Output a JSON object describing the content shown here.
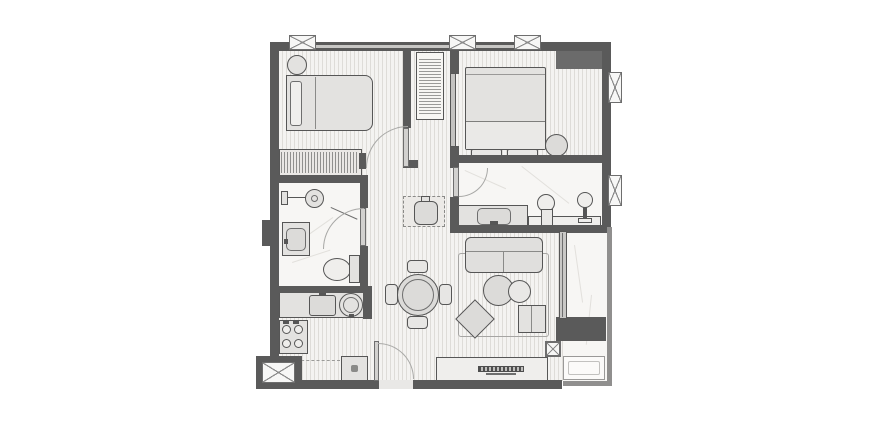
{
  "drawing": {
    "kind": "architectural-floor-plan",
    "description": "monochrome top-down apartment floor plan, no text labels",
    "palette": {
      "background": "#ffffff",
      "wall": "#5a5a5a",
      "parapet": "#908f8e",
      "outline": "#565656",
      "wood_floor_base": "#f4f3f1",
      "wood_floor_stripe": "#dedcd8",
      "marble_floor": "#f7f6f4",
      "furniture_fill": "#e3e2e0",
      "glass": "#c9c8c6",
      "door_arc": "#a8a8a6"
    },
    "rooms": [
      {
        "name": "bedroom-1",
        "floor": "wood",
        "furniture": [
          "single-bed",
          "pillow",
          "round-stool",
          "hatched-dresser"
        ]
      },
      {
        "name": "hallway",
        "floor": "wood",
        "furniture": [
          "hatched-closet"
        ]
      },
      {
        "name": "bedroom-2",
        "floor": "wood",
        "furniture": [
          "double-bed",
          "two-foot-benches",
          "round-planter",
          "built-in-wardrobe"
        ]
      },
      {
        "name": "bathroom-1",
        "floor": "marble",
        "furniture": [
          "shower-head",
          "glass-screen",
          "vanity-sink",
          "toilet"
        ]
      },
      {
        "name": "ensuite-bathroom",
        "floor": "marble",
        "furniture": [
          "vanity-sink",
          "toilet",
          "pedestal-basin",
          "shelf-counter"
        ]
      },
      {
        "name": "kitchen",
        "floor": "wood",
        "furniture": [
          "counter",
          "kitchen-sink",
          "round-basin",
          "four-burner-stove",
          "appliance-cabinet",
          "dashed-cabinet-line"
        ]
      },
      {
        "name": "living-dining",
        "floor": "wood",
        "furniture": [
          "round-dining-table",
          "four-chairs",
          "two-seat-sofa",
          "rug",
          "round-coffee-tables",
          "rotated-ottoman",
          "side-table",
          "tv-console",
          "laundry-cabinet"
        ]
      },
      {
        "name": "balcony",
        "floor": "marble",
        "furniture": [
          "planter-bench"
        ]
      },
      {
        "name": "service-shaft",
        "floor": "none",
        "furniture": [
          "x-cross-symbol"
        ]
      }
    ],
    "symbols": {
      "top_wall_vent_boxes": 3,
      "right_wall_window_boxes": 2,
      "swing_door_arcs": 4,
      "sliding_panel_doors": 1,
      "glass_wall_sections": 1,
      "window_glazing_strips": 2
    }
  }
}
